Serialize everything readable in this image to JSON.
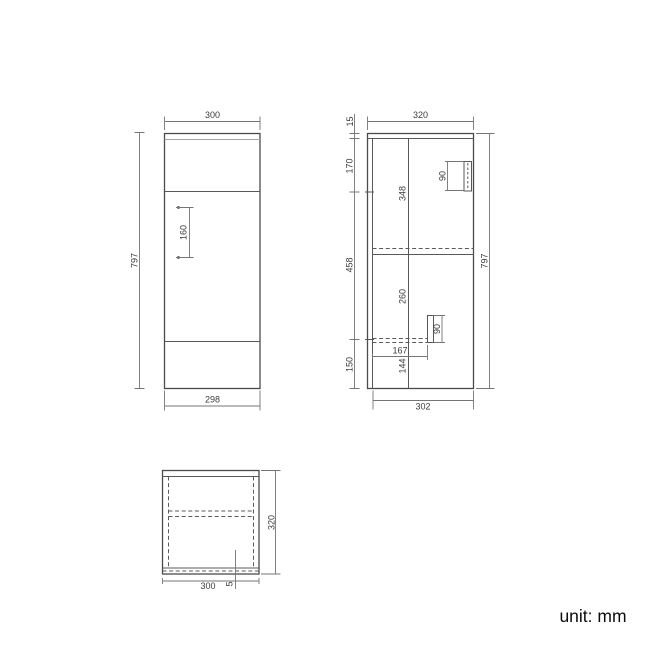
{
  "unit": {
    "label": "unit: mm"
  },
  "front_view": {
    "width_top": "300",
    "height_left": "797",
    "hole_spacing": "160",
    "width_bottom": "298"
  },
  "side_view": {
    "depth_top": "320",
    "worktop_thickness": "15",
    "segment_upper": "170",
    "segment_middle": "458",
    "segment_bottom": "150",
    "height_right": "797",
    "upper_section": "348",
    "lower_section": "260",
    "handle_top_length": "90",
    "handle_bottom_length": "90",
    "handle_offset": "167",
    "bottom_inner": "144",
    "depth_bottom": "302"
  },
  "top_view": {
    "width_bottom": "300",
    "edge_gap": "5",
    "depth_right": "320"
  },
  "colors": {
    "background": "#ffffff",
    "outline": "#4b4b4b",
    "dimension_line": "#757575",
    "hidden_line": "#5a5a5a",
    "label_text": "#3c3c3c",
    "unit_text": "#0c0c0c"
  }
}
